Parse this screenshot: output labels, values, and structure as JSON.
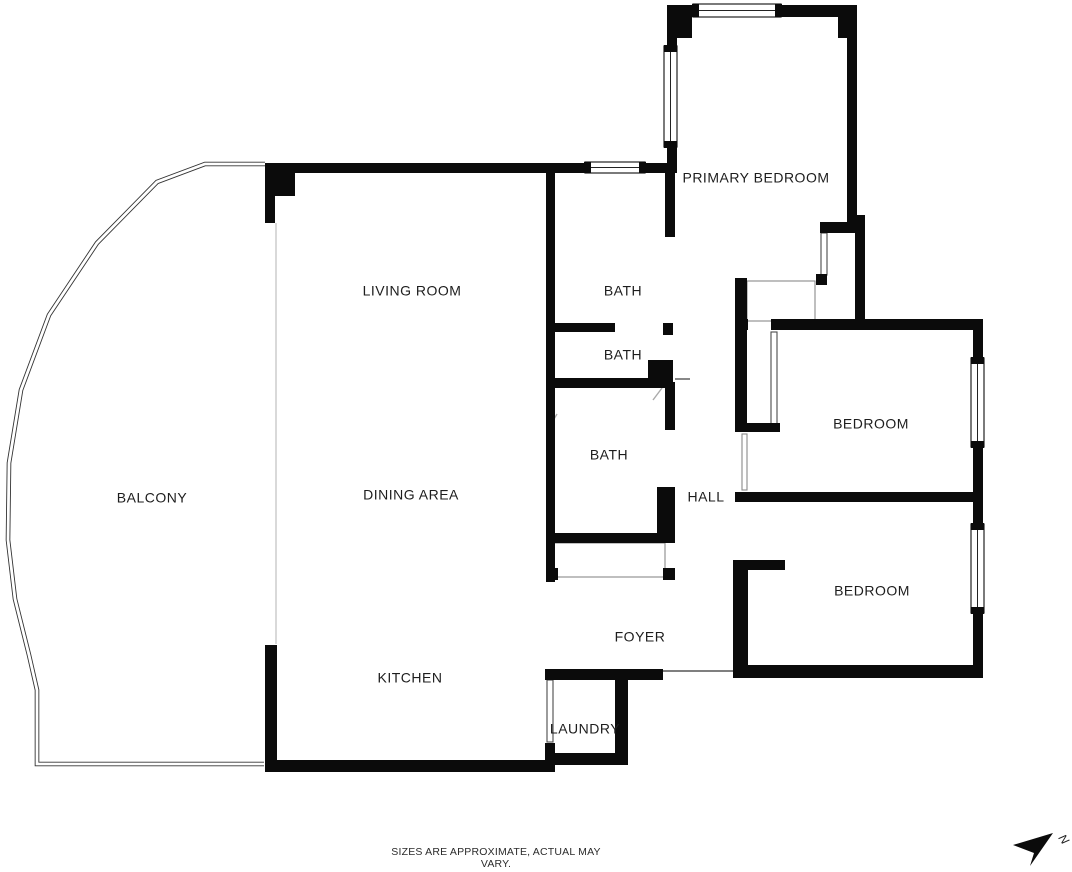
{
  "disclaimer": "SIZES ARE APPROXIMATE, ACTUAL MAY VARY.",
  "colors": {
    "wall": "#0b0b0b",
    "window_border": "#222222",
    "label": "#1d1d1d",
    "balcony_line": "#333333",
    "open_boundary": "#c9c9c9",
    "thin_detail": "#4a4a4a",
    "light_detail": "#8a8a8a",
    "door_swing": "#aaaaaa"
  },
  "rooms": [
    {
      "name": "balcony",
      "label": "BALCONY",
      "x": 152,
      "y": 499
    },
    {
      "name": "living-room",
      "label": "LIVING ROOM",
      "x": 412,
      "y": 292
    },
    {
      "name": "dining-area",
      "label": "DINING AREA",
      "x": 411,
      "y": 496
    },
    {
      "name": "kitchen",
      "label": "KITCHEN",
      "x": 410,
      "y": 679
    },
    {
      "name": "bath-top",
      "label": "BATH",
      "x": 623,
      "y": 292
    },
    {
      "name": "bath-middle",
      "label": "BATH",
      "x": 623,
      "y": 356
    },
    {
      "name": "bath-lower",
      "label": "BATH",
      "x": 609,
      "y": 456
    },
    {
      "name": "hall",
      "label": "HALL",
      "x": 706,
      "y": 498
    },
    {
      "name": "foyer",
      "label": "FOYER",
      "x": 640,
      "y": 638
    },
    {
      "name": "laundry",
      "label": "LAUNDRY",
      "x": 585,
      "y": 730
    },
    {
      "name": "primary-bedroom",
      "label": "PRIMARY BEDROOM",
      "x": 756,
      "y": 179
    },
    {
      "name": "bedroom-upper",
      "label": "BEDROOM",
      "x": 871,
      "y": 425
    },
    {
      "name": "bedroom-lower",
      "label": "BEDROOM",
      "x": 872,
      "y": 592
    }
  ],
  "plan": {
    "balcony_path": "M 265 164 L 205 164 L 157 182 L 97 243 L 49 315 L 21 390 L 9 463 L 8 540 L 15 599 L 29 655 L 37 690 L 37 764 L 264 764",
    "walls": [
      [
        667,
        5,
        28,
        12
      ],
      [
        780,
        5,
        77,
        12
      ],
      [
        667,
        5,
        25,
        33
      ],
      [
        838,
        15,
        19,
        23
      ],
      [
        847,
        17,
        10,
        206
      ],
      [
        667,
        37,
        10,
        12
      ],
      [
        667,
        146,
        10,
        27
      ],
      [
        265,
        163,
        30,
        33
      ],
      [
        265,
        196,
        10,
        27
      ],
      [
        265,
        163,
        322,
        10
      ],
      [
        643,
        163,
        25,
        10
      ],
      [
        665,
        163,
        10,
        74
      ],
      [
        546,
        172,
        9,
        410
      ],
      [
        546,
        323,
        69,
        9
      ],
      [
        663,
        323,
        10,
        12
      ],
      [
        546,
        378,
        104,
        10
      ],
      [
        648,
        360,
        25,
        28
      ],
      [
        665,
        382,
        10,
        48
      ],
      [
        657,
        487,
        18,
        51
      ],
      [
        553,
        533,
        122,
        10
      ],
      [
        546,
        568,
        12,
        12
      ],
      [
        663,
        568,
        12,
        12
      ],
      [
        820,
        222,
        43,
        11
      ],
      [
        816,
        274,
        11,
        11
      ],
      [
        855,
        215,
        10,
        115
      ],
      [
        735,
        278,
        12,
        154
      ],
      [
        747,
        423,
        33,
        9
      ],
      [
        735,
        319,
        13,
        11
      ],
      [
        771,
        319,
        212,
        11
      ],
      [
        973,
        330,
        10,
        31
      ],
      [
        973,
        445,
        10,
        47
      ],
      [
        735,
        492,
        248,
        10
      ],
      [
        733,
        560,
        15,
        118
      ],
      [
        748,
        560,
        37,
        10
      ],
      [
        973,
        502,
        10,
        24
      ],
      [
        973,
        612,
        10,
        66
      ],
      [
        735,
        665,
        248,
        13
      ],
      [
        545,
        669,
        118,
        11
      ],
      [
        615,
        669,
        13,
        96
      ],
      [
        545,
        743,
        10,
        22
      ],
      [
        553,
        753,
        75,
        12
      ],
      [
        265,
        760,
        290,
        12
      ],
      [
        265,
        645,
        12,
        115
      ]
    ],
    "windows": [
      {
        "x": 693,
        "y": 4,
        "w": 88,
        "h": 13,
        "dir": "h",
        "name": "primary-bedroom-top-window"
      },
      {
        "x": 664,
        "y": 46,
        "w": 13,
        "h": 101,
        "dir": "v",
        "name": "primary-bedroom-left-window"
      },
      {
        "x": 585,
        "y": 162,
        "w": 60,
        "h": 11,
        "dir": "h",
        "name": "living-room-top-window"
      },
      {
        "x": 971,
        "y": 358,
        "w": 13,
        "h": 89,
        "dir": "v",
        "name": "bedroom-upper-window"
      },
      {
        "x": 971,
        "y": 524,
        "w": 13,
        "h": 89,
        "dir": "v",
        "name": "bedroom-lower-window"
      }
    ],
    "thin_rects": [
      {
        "x": 821,
        "y": 233,
        "w": 6,
        "h": 42,
        "c": "#4a4a4a",
        "name": "primary-closet-door"
      },
      {
        "x": 747,
        "y": 281,
        "w": 68,
        "h": 40,
        "c": "#8a8a8a",
        "name": "hall-closet"
      },
      {
        "x": 771,
        "y": 332,
        "w": 6,
        "h": 92,
        "c": "#4a4a4a",
        "name": "bedroom-upper-door-leaf"
      },
      {
        "x": 742,
        "y": 434,
        "w": 5,
        "h": 56,
        "c": "#8a8a8a",
        "name": "hall-opening-jamb"
      },
      {
        "x": 553,
        "y": 543,
        "w": 112,
        "h": 34,
        "c": "#8a8a8a",
        "name": "bath-closet"
      },
      {
        "x": 547,
        "y": 680,
        "w": 6,
        "h": 62,
        "c": "#4a4a4a",
        "name": "laundry-door-opening"
      }
    ],
    "thin_lines": [
      {
        "x1": 663,
        "y1": 671,
        "x2": 733,
        "y2": 671,
        "c": "#555555",
        "name": "foyer-entry-threshold"
      },
      {
        "x1": 675,
        "y1": 379,
        "x2": 690,
        "y2": 379,
        "c": "#555555",
        "name": "hall-threshold"
      },
      {
        "x1": 276,
        "y1": 223,
        "x2": 276,
        "y2": 644,
        "c": "#c9c9c9",
        "name": "balcony-open-boundary"
      },
      {
        "x1": 548,
        "y1": 429,
        "x2": 557,
        "y2": 414,
        "c": "#aaaaaa",
        "name": "bath-door-swing"
      },
      {
        "x1": 653,
        "y1": 400,
        "x2": 662,
        "y2": 388,
        "c": "#aaaaaa",
        "name": "bath2-door-swing"
      }
    ]
  },
  "compass": {
    "points": "1053,833 1013,845 1034,853 1030,866",
    "label": "N",
    "label_x": 1058,
    "label_y": 838,
    "label_rotate": 55
  }
}
